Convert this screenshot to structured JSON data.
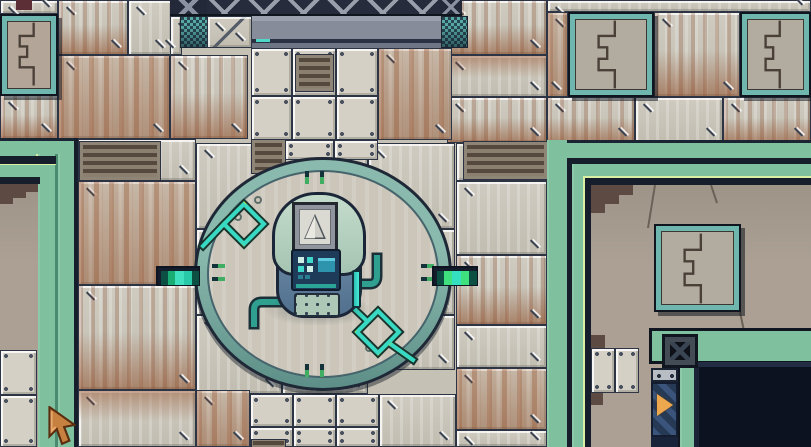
{
  "scene": {
    "type": "game-screenshot",
    "description": "Top-down pixel-art sci-fi facility room. A large circular dais in the center holds a squat robot console with a triangle display. Riveted metal floor tiles with rust stains surround it. Green-trimmed raised walls frame the left and right sides, with teal-framed puzzle-etched panels, slatted vents, a dark pit entrance at lower right, and a tan arrow cursor at lower left.",
    "objects": {
      "robot_console": "cylindrical robot console with triangle display screen, navy control panel and teal pipes",
      "central_platform": "large circular dais with tick marks, ring rivets and zigzag energy traces",
      "left_coupler": "segmented glowing power coupler entering dais from the left",
      "right_coupler": "segmented glowing power coupler entering dais from the right",
      "puzzle_panels": "teal-framed wall panels etched with interlocking puzzle lines",
      "vent_grates": "brown slatted ventilation grates",
      "machine_door_top": "dark lattice machine face with grey lintel at top center",
      "pit_entrance": "dark rectangular opening bordered in green at lower right",
      "direction_sign": "navy striped banner with orange arrow beside the pit",
      "gem_block": "dark inset block with sparkle at pit corner",
      "cursor": "pixel-art arrow pointer near lower left"
    }
  },
  "colors": {
    "floor_tile": "#c9c5b9",
    "tile_outline": "#2d3444",
    "rust": "#94522e",
    "platform_green": "#7fc19f",
    "trim_bright": "#d9f0a2",
    "trim_navy": "#161e2c",
    "ring_teal": "#6fa09b",
    "dais_floor": "#cbc6b9",
    "zigzag_green": "#8fe866",
    "zigzag_cyan": "#37d9c4",
    "robot_dome": "#b9d3c2",
    "robot_base": "#5f7f9d",
    "panel_navy": "#1e3c59",
    "panel_cyan": "#3fd9cb",
    "pipe_teal": "#2f9f90",
    "pit_dark": "#0d1220",
    "banner_navy": "#273a55",
    "arrow_orange": "#eda84f",
    "cursor_tan": "#c6803f"
  }
}
